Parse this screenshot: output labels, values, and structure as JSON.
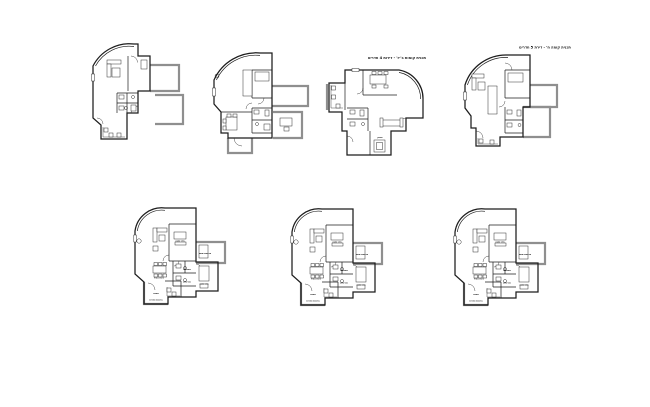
{
  "document": {
    "type": "architectural-floor-plan-sheet",
    "background": "#ffffff",
    "plan_count": 7
  },
  "colors": {
    "line": "#1c1c1c",
    "balcony": "#8f8f8f",
    "label": "#111111"
  },
  "titles": [
    {
      "id": "title-left",
      "text": "תכנית קומות ב'-ז' - דירות 4 חדרים"
    },
    {
      "id": "title-right",
      "text": "תכנית קומה ח' - דירת 5 חדרים"
    }
  ],
  "room_labels": {
    "bedroom": "חדר שינה",
    "bath": "אמבטיה",
    "wc": "שירותים",
    "kitchen": "מטבח",
    "dining": "פינת אוכל",
    "balcony": "מרפסת שמש",
    "service_balcony": "מרפסת שירות",
    "storage": "מחסן",
    "living": "סלון"
  },
  "plans": [
    {
      "id": "floor-plan-1",
      "row": "top",
      "position": 1
    },
    {
      "id": "floor-plan-2",
      "row": "top",
      "position": 2
    },
    {
      "id": "floor-plan-3",
      "row": "top",
      "position": 3
    },
    {
      "id": "floor-plan-4",
      "row": "top",
      "position": 4
    },
    {
      "id": "floor-plan-5",
      "row": "bottom",
      "position": 1
    },
    {
      "id": "floor-plan-6",
      "row": "bottom",
      "position": 2
    },
    {
      "id": "floor-plan-7",
      "row": "bottom",
      "position": 3
    }
  ]
}
